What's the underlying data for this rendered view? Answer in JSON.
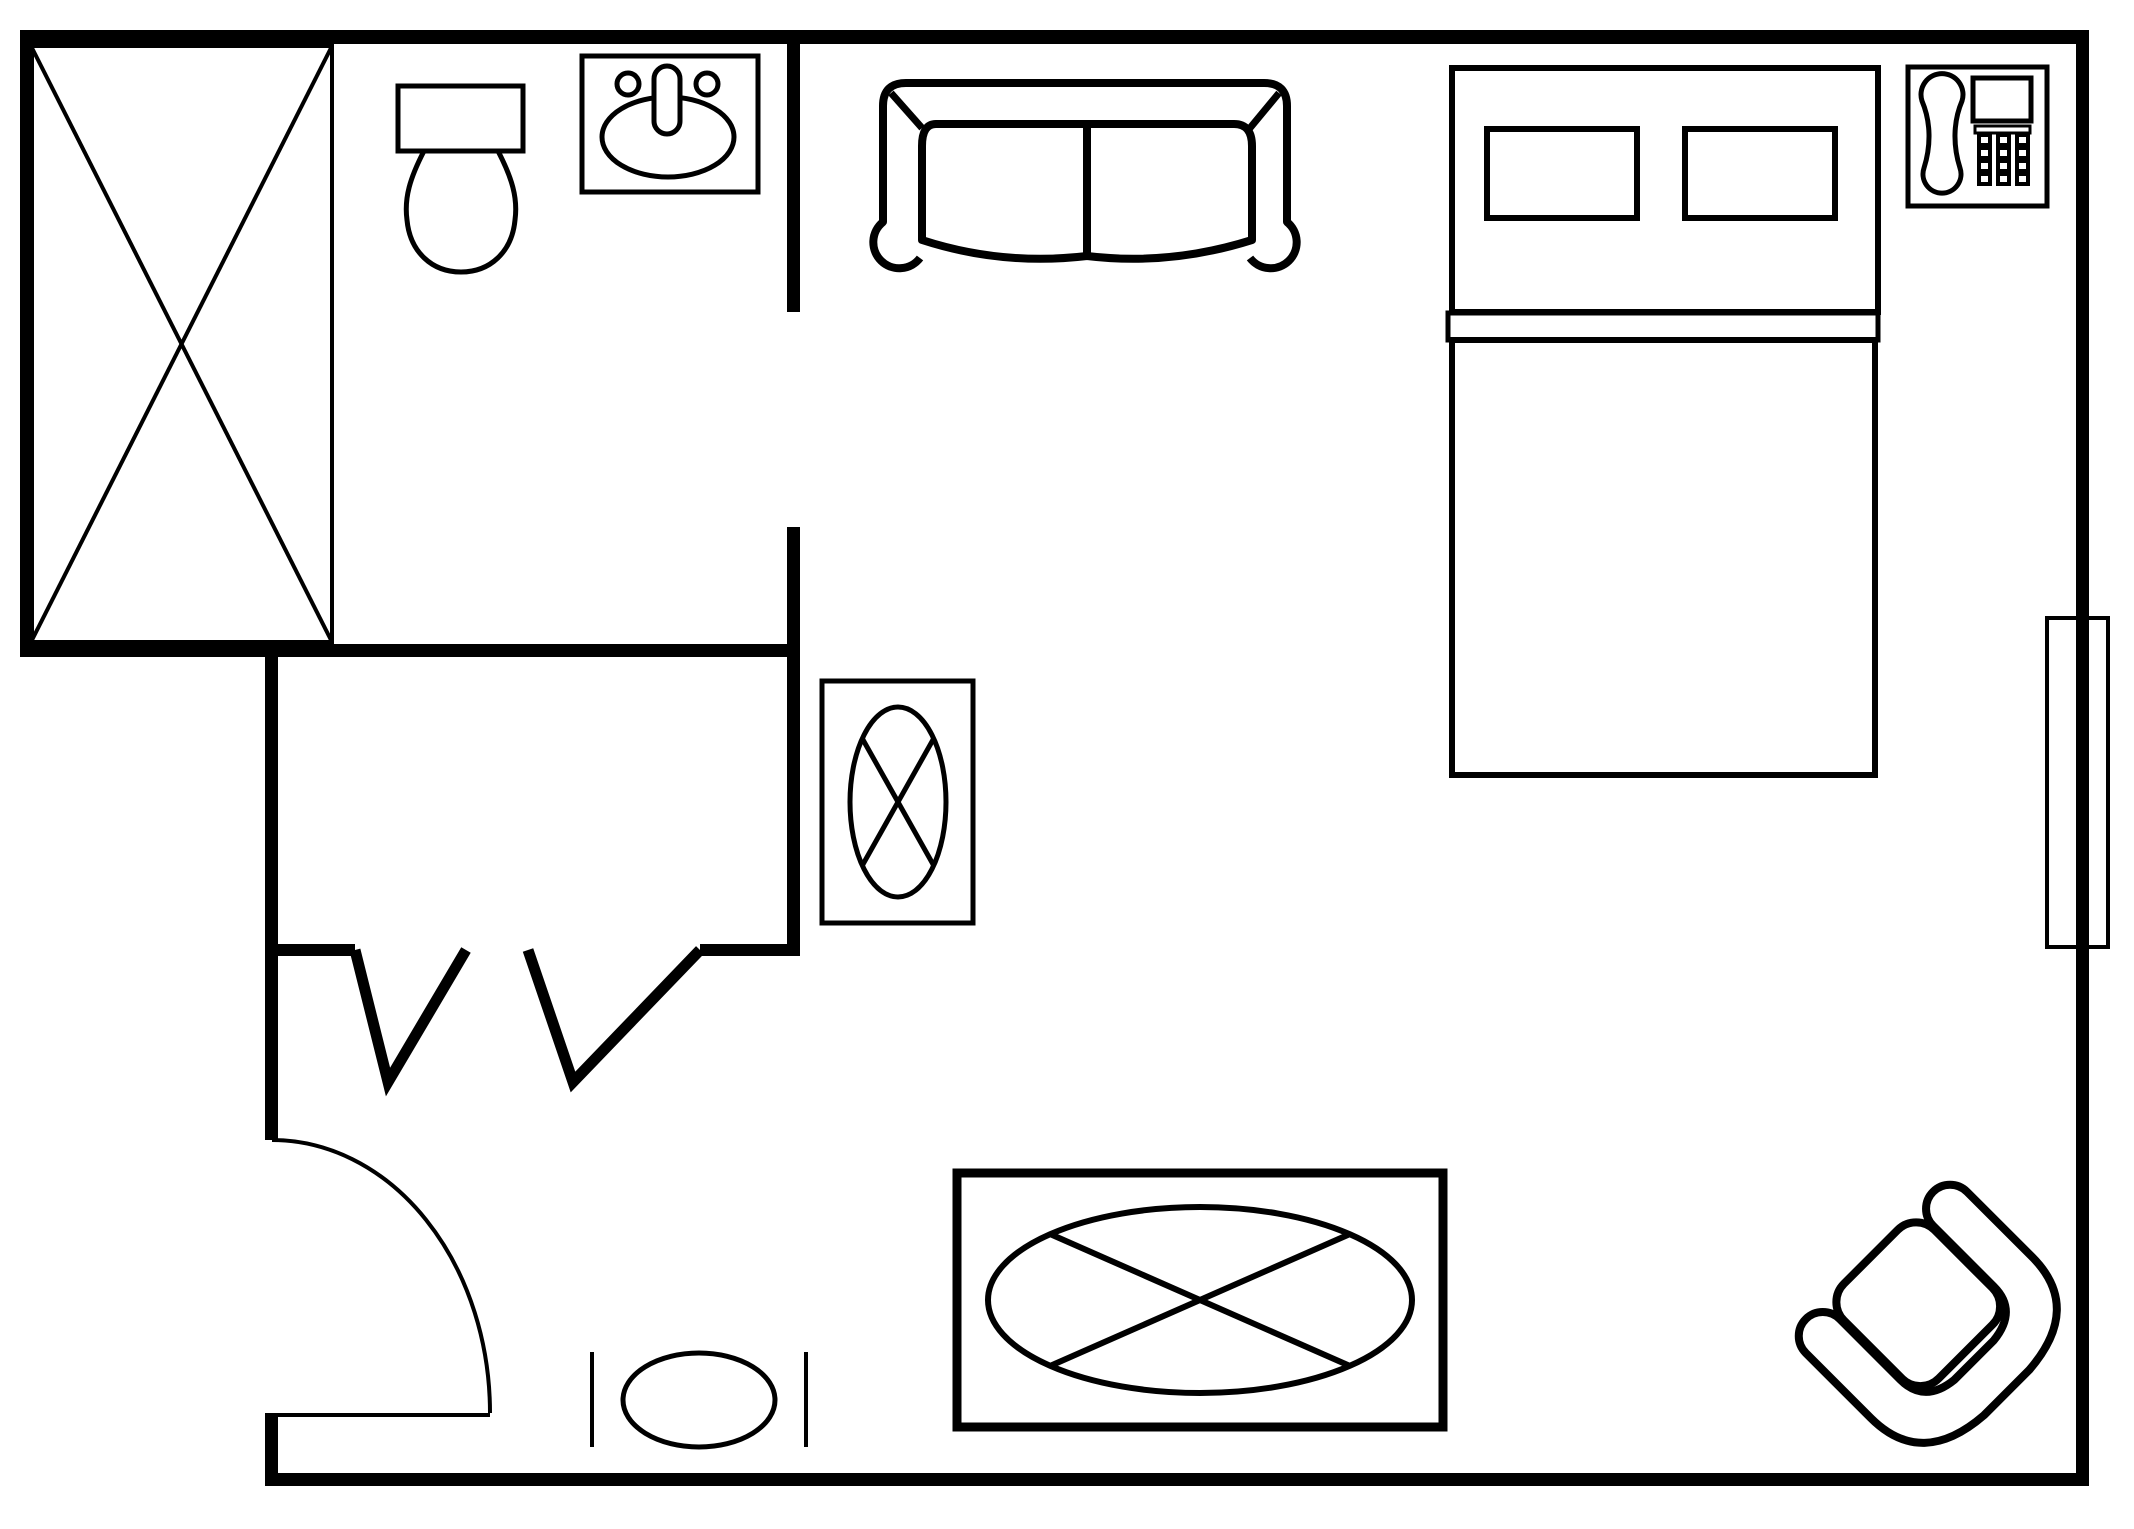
{
  "document": {
    "type": "floor-plan",
    "title": "Studio / hotel-room floor plan (top view, black line drawing)",
    "canvas": {
      "width": 2134,
      "height": 1529,
      "background": "#ffffff",
      "line_color": "#000000"
    },
    "visible_text": []
  },
  "rooms": [
    {
      "name": "bathroom",
      "area": "top-left",
      "contains": [
        "bathtub",
        "toilet",
        "sink"
      ]
    },
    {
      "name": "closet",
      "area": "mid-left",
      "contains": [
        "bifold-door-left",
        "bifold-door-right"
      ]
    },
    {
      "name": "main-room",
      "area": "right",
      "contains": [
        "sofa",
        "bed",
        "telephone-table",
        "mirror-table",
        "dining-table",
        "armchair",
        "stool",
        "window"
      ]
    }
  ],
  "walls": {
    "color": "#000000",
    "segments": [
      {
        "name": "wall-top",
        "x": 20,
        "y": 30,
        "w": 2069,
        "h": 14
      },
      {
        "name": "wall-right",
        "x": 2076,
        "y": 30,
        "w": 13,
        "h": 1456
      },
      {
        "name": "wall-bottom",
        "x": 265,
        "y": 1473,
        "w": 1824,
        "h": 13
      },
      {
        "name": "wall-left",
        "x": 20,
        "y": 30,
        "w": 14,
        "h": 626
      },
      {
        "name": "wall-bathroom-bottom",
        "x": 20,
        "y": 644,
        "w": 780,
        "h": 13
      },
      {
        "name": "wall-inner-upper",
        "x": 787,
        "y": 30,
        "w": 13,
        "h": 282
      },
      {
        "name": "wall-inner-lower",
        "x": 787,
        "y": 527,
        "w": 13,
        "h": 427
      },
      {
        "name": "wall-closet-left",
        "x": 265,
        "y": 644,
        "w": 13,
        "h": 496
      },
      {
        "name": "wall-closet-stub-left",
        "x": 265,
        "y": 944,
        "w": 90,
        "h": 12
      },
      {
        "name": "wall-closet-stub-right",
        "x": 700,
        "y": 944,
        "w": 100,
        "h": 12
      },
      {
        "name": "wall-entry-stub",
        "x": 265,
        "y": 1413,
        "w": 13,
        "h": 73
      }
    ]
  },
  "openings": [
    {
      "name": "bathroom-doorway",
      "wall": "wall-inner",
      "from_y": 312,
      "to_y": 527
    },
    {
      "name": "closet-bifold-doors",
      "edge_y": 950,
      "door1": [
        [
          355,
          950
        ],
        [
          388,
          1082
        ],
        [
          466,
          950
        ]
      ],
      "door2": [
        [
          528,
          950
        ],
        [
          573,
          1082
        ],
        [
          700,
          950
        ]
      ]
    },
    {
      "name": "entry-door",
      "opening_x": 272,
      "from_y": 1140,
      "to_y": 1415,
      "swing": "quarter-arc into room, hinged at bottom"
    }
  ],
  "furniture": [
    {
      "name": "bathtub",
      "bbox": [
        31,
        46,
        332,
        642
      ],
      "symbol": "rectangle with corner-to-corner X"
    },
    {
      "name": "toilet",
      "bbox": [
        398,
        86,
        523,
        273
      ],
      "symbol": "tank rectangle + oval bowl"
    },
    {
      "name": "sink",
      "bbox": [
        582,
        56,
        758,
        192
      ],
      "symbol": "counter square, oval basin, faucet, 2 handles"
    },
    {
      "name": "sofa",
      "bbox": [
        865,
        83,
        1300,
        270
      ],
      "symbol": "two-seat couch, rolled arms, top view"
    },
    {
      "name": "bed",
      "bbox": [
        1448,
        68,
        1878,
        775
      ],
      "symbol": "headboard with 2 pillows, fold band, mattress"
    },
    {
      "name": "telephone",
      "bbox": [
        1908,
        67,
        2047,
        206
      ],
      "symbol": "handset + display + 3x4 keypad"
    },
    {
      "name": "window",
      "bbox": [
        2047,
        618,
        2108,
        947
      ],
      "symbol": "thin rectangle straddling right wall"
    },
    {
      "name": "mirror-table",
      "bbox": [
        822,
        681,
        973,
        923
      ],
      "symbol": "rectangle with crossed oval"
    },
    {
      "name": "dining-table",
      "bbox": [
        957,
        1173,
        1443,
        1427
      ],
      "symbol": "rectangle with crossed oval top"
    },
    {
      "name": "stool",
      "bbox": [
        588,
        1352,
        810,
        1447
      ],
      "symbol": "oval between two side rails"
    },
    {
      "name": "armchair",
      "bbox": [
        1800,
        1178,
        2055,
        1450
      ],
      "symbol": "rotated tub chair with wrap-around back"
    }
  ]
}
